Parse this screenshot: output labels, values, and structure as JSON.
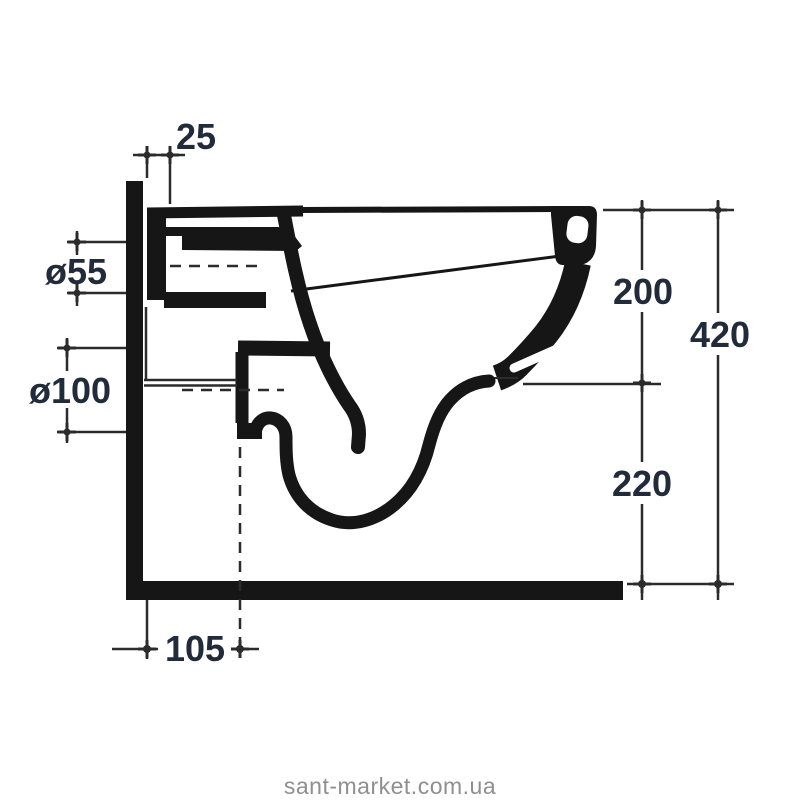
{
  "colors": {
    "background": "#ffffff",
    "line": "#161616",
    "thin_line": "#2b2b2b",
    "dimension_text": "#222b3a",
    "watermark": "#8f8f8f"
  },
  "drawing": {
    "type": "technical-dimension-diagram",
    "subject": "wall-hung toilet bowl side cross-section with installation dimensions",
    "dimensions": {
      "d25": "25",
      "d55": "ø55",
      "d100": "ø100",
      "d200": "200",
      "d420": "420",
      "d220": "220",
      "d105": "105"
    }
  },
  "watermark": {
    "text": "sant-market.com.ua"
  }
}
